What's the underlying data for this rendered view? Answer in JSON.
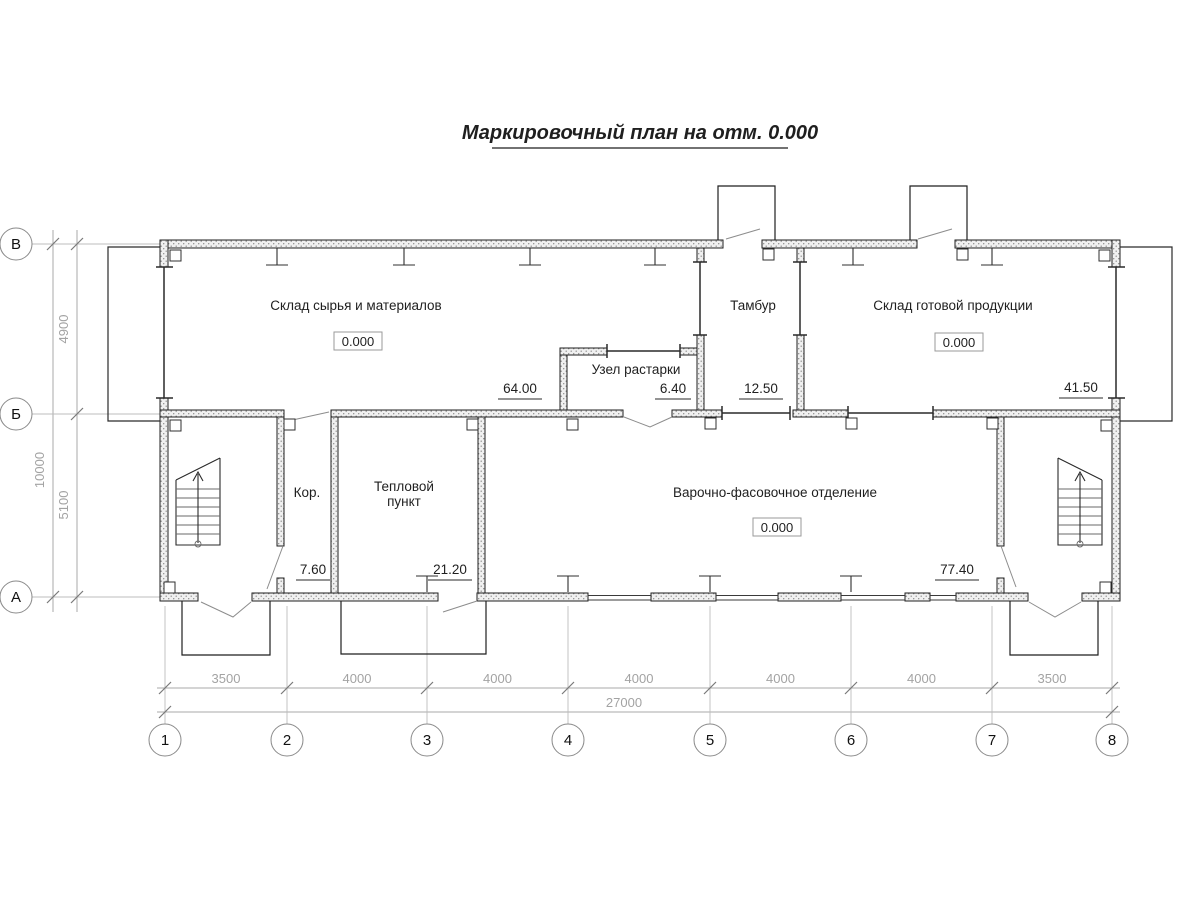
{
  "title": {
    "text": "Маркировочный план на отм. 0.000"
  },
  "rooms": {
    "raw_materials_warehouse": {
      "name": "Склад сырья и материалов",
      "elevation": "0.000",
      "area": "64.00"
    },
    "unpacking_unit": {
      "name": "Узел растарки",
      "area": "6.40"
    },
    "vestibule": {
      "name": "Тамбур",
      "area": "12.50"
    },
    "finished_goods_warehouse": {
      "name": "Склад готовой продукции",
      "elevation": "0.000",
      "area": "41.50"
    },
    "corridor": {
      "name": "Кор.",
      "area": "7.60"
    },
    "heating_station": {
      "name_line1": "Тепловой",
      "name_line2": "пункт",
      "area": "21.20"
    },
    "cooking_packing_dept": {
      "name": "Варочно-фасовочное отделение",
      "elevation": "0.000",
      "area": "77.40"
    }
  },
  "axes": {
    "horizontal": [
      "1",
      "2",
      "3",
      "4",
      "5",
      "6",
      "7",
      "8"
    ],
    "vertical": [
      "В",
      "Б",
      "А"
    ]
  },
  "dimensions": {
    "bottom_segments": [
      "3500",
      "4000",
      "4000",
      "4000",
      "4000",
      "4000",
      "3500"
    ],
    "bottom_total": "27000",
    "left_segments": [
      "4900",
      "5100"
    ],
    "left_total": "10000"
  },
  "colors": {
    "line": "#1f1f1f",
    "dim_text": "#a3a3a3",
    "wall_fill": "#8d8d8d"
  }
}
